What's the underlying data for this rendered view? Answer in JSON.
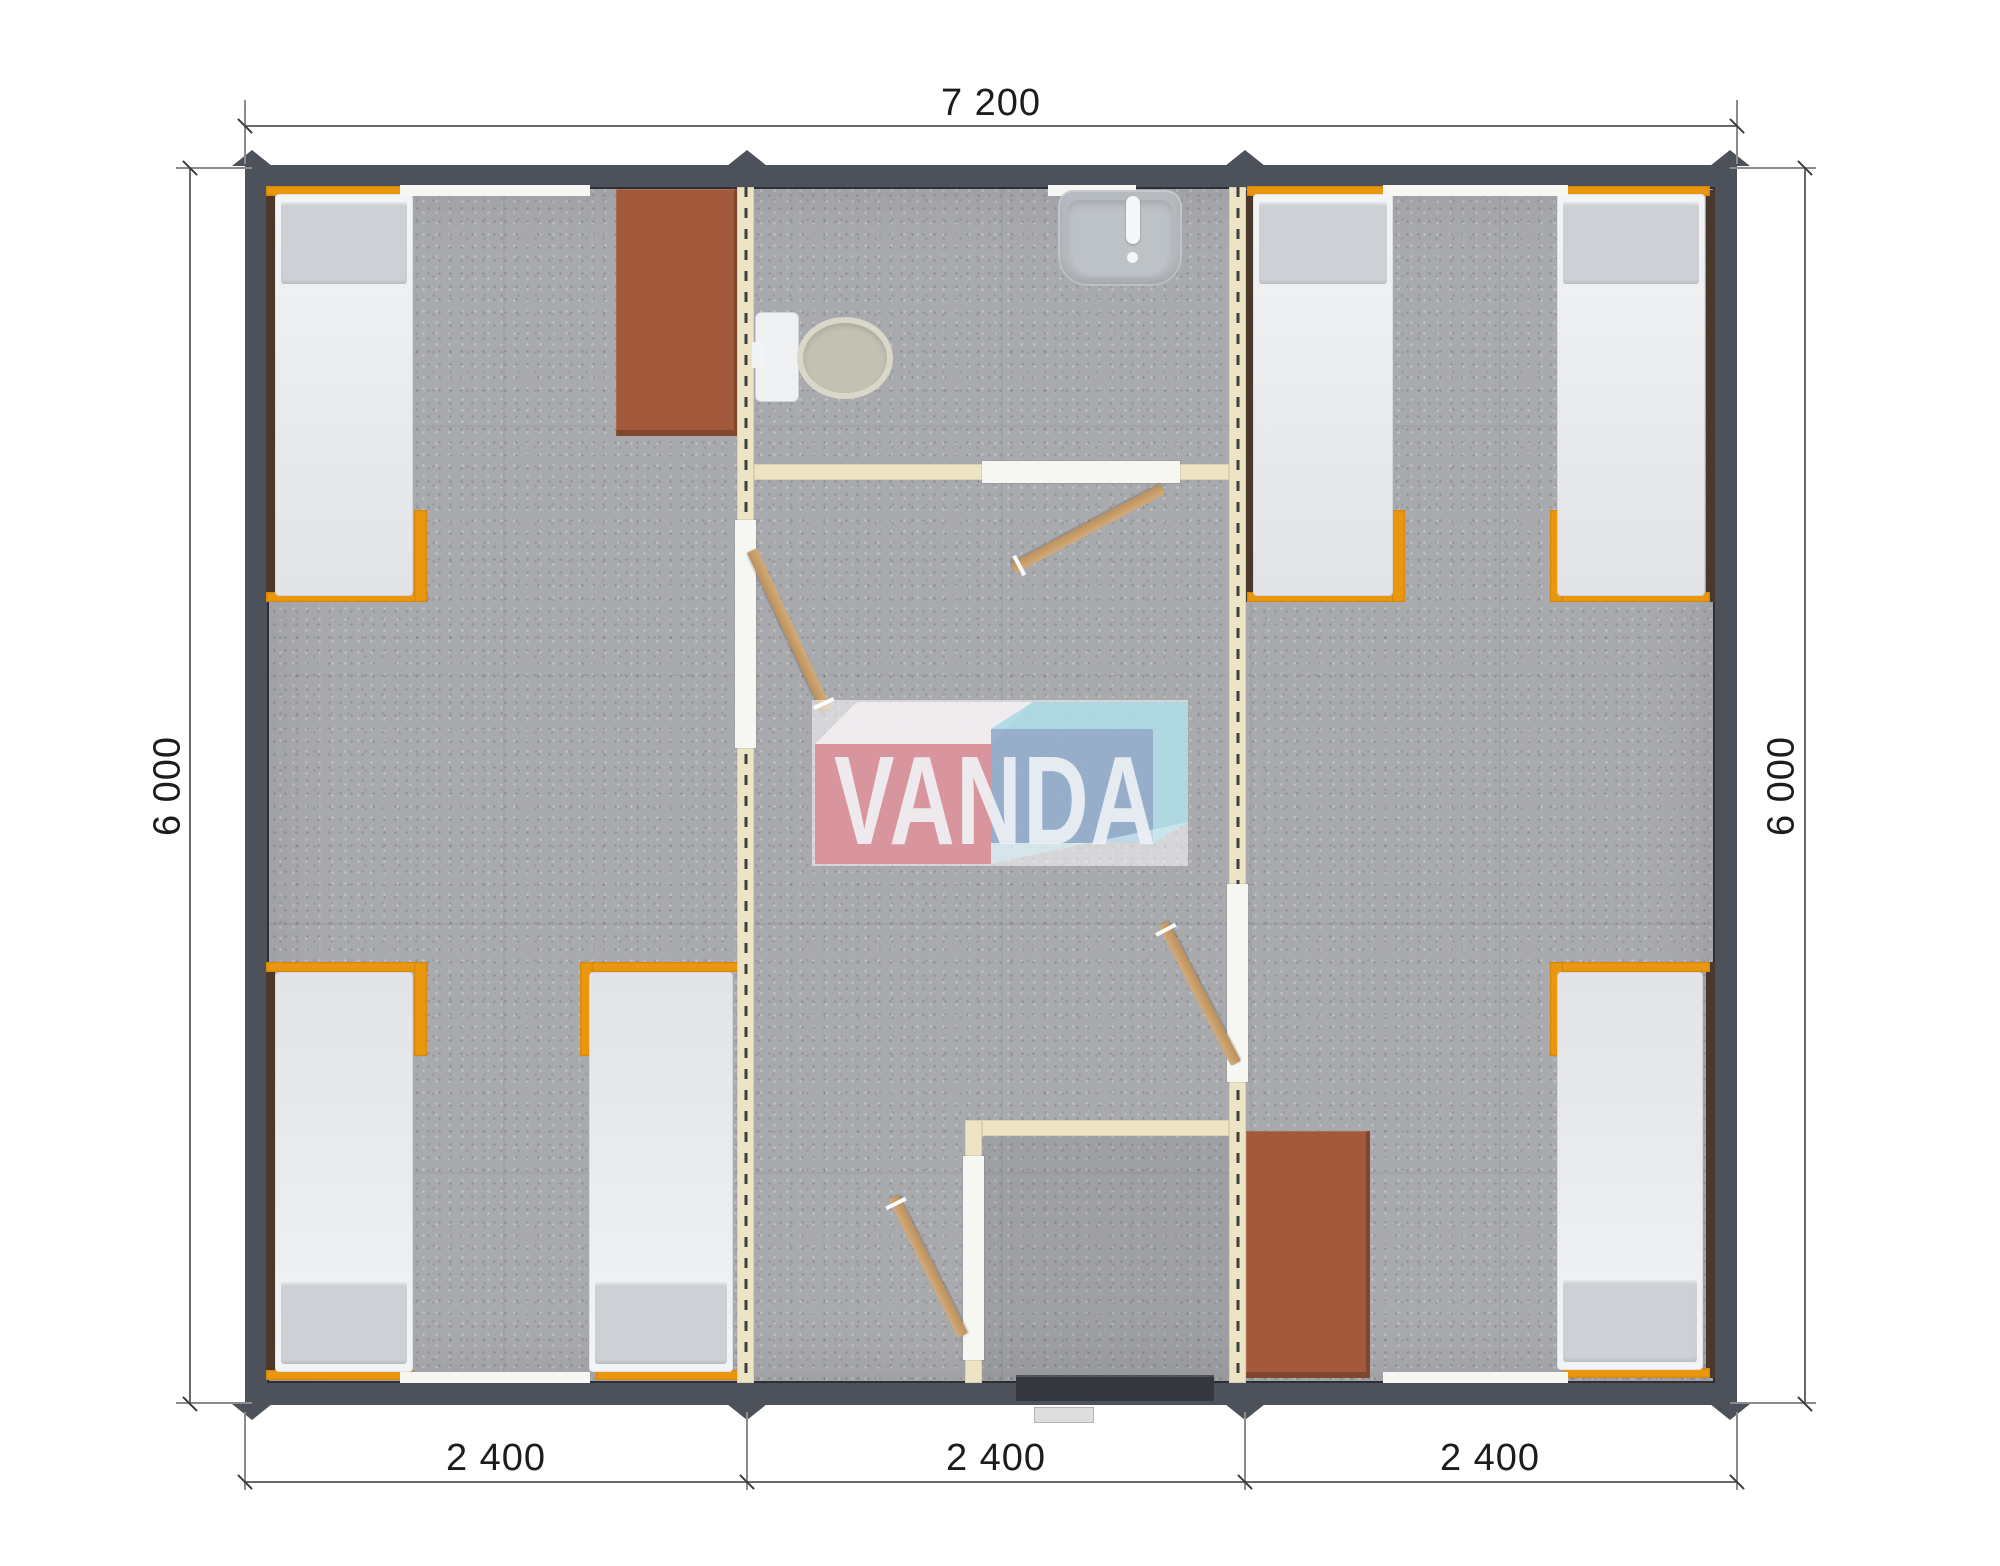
{
  "dimensions": {
    "top_width": "7 200",
    "left_height": "6 000",
    "right_height": "6 000",
    "modules": [
      "2 400",
      "2 400",
      "2 400"
    ]
  },
  "watermark": {
    "text": "VANDA"
  },
  "palette": {
    "outer_wall": "#4d515a",
    "partition": "#ece4c4",
    "floor": "#a9aaae",
    "bed_frame": "#ea970e",
    "pillow": "#cdd1d6",
    "desk": "#a2593c",
    "door_wood": "#c8a26e",
    "brown_strip": "#4a382b",
    "window": "#f6f6f3",
    "fixture": "#b6bbc0",
    "watermark_red": "#d98a93",
    "watermark_blue": "#8ca7c8",
    "watermark_cyan": "#a6d8e4",
    "dimension_text": "#1c1c1c"
  }
}
